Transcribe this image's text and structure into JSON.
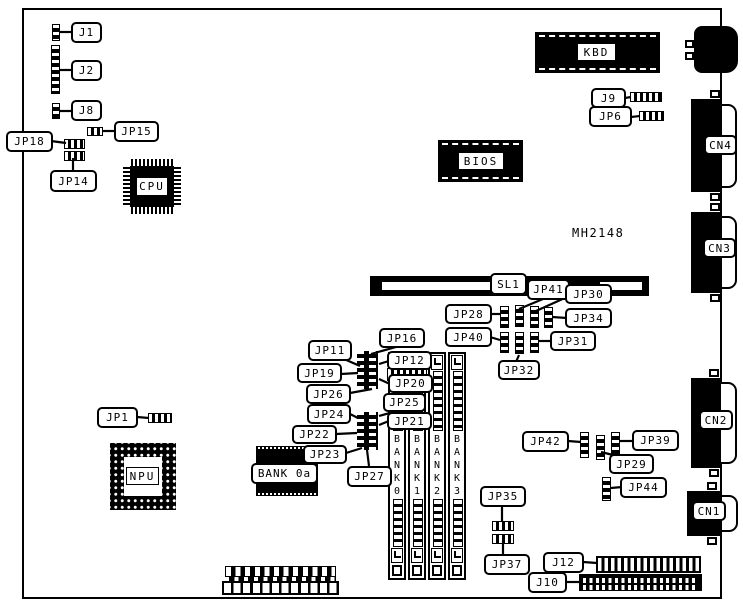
{
  "diagram": {
    "part_number": "MH2148",
    "chips": {
      "cpu": "CPU",
      "npu": "NPU",
      "bios": "BIOS",
      "kbd": "KBD"
    },
    "slot": {
      "sl1": "SL1"
    },
    "memory": {
      "bank0a": "BANK 0a",
      "banks": [
        "BANK0",
        "BANK1",
        "BANK2",
        "BANK3"
      ]
    },
    "connectors": {
      "j1": "J1",
      "j2": "J2",
      "j8": "J8",
      "j9": "J9",
      "j10": "J10",
      "j12": "J12",
      "cn1": "CN1",
      "cn2": "CN2",
      "cn3": "CN3",
      "cn4": "CN4"
    },
    "jumpers": {
      "jp1": "JP1",
      "jp6": "JP6",
      "jp11": "JP11",
      "jp12": "JP12",
      "jp14": "JP14",
      "jp15": "JP15",
      "jp16": "JP16",
      "jp18": "JP18",
      "jp19": "JP19",
      "jp20": "JP20",
      "jp21": "JP21",
      "jp22": "JP22",
      "jp23": "JP23",
      "jp24": "JP24",
      "jp25": "JP25",
      "jp26": "JP26",
      "jp27": "JP27",
      "jp28": "JP28",
      "jp29": "JP29",
      "jp30": "JP30",
      "jp31": "JP31",
      "jp32": "JP32",
      "jp34": "JP34",
      "jp35": "JP35",
      "jp37": "JP37",
      "jp39": "JP39",
      "jp40": "JP40",
      "jp41": "JP41",
      "jp42": "JP42",
      "jp44": "JP44"
    },
    "colors": {
      "ink": "#000000",
      "paper": "#ffffff"
    }
  }
}
